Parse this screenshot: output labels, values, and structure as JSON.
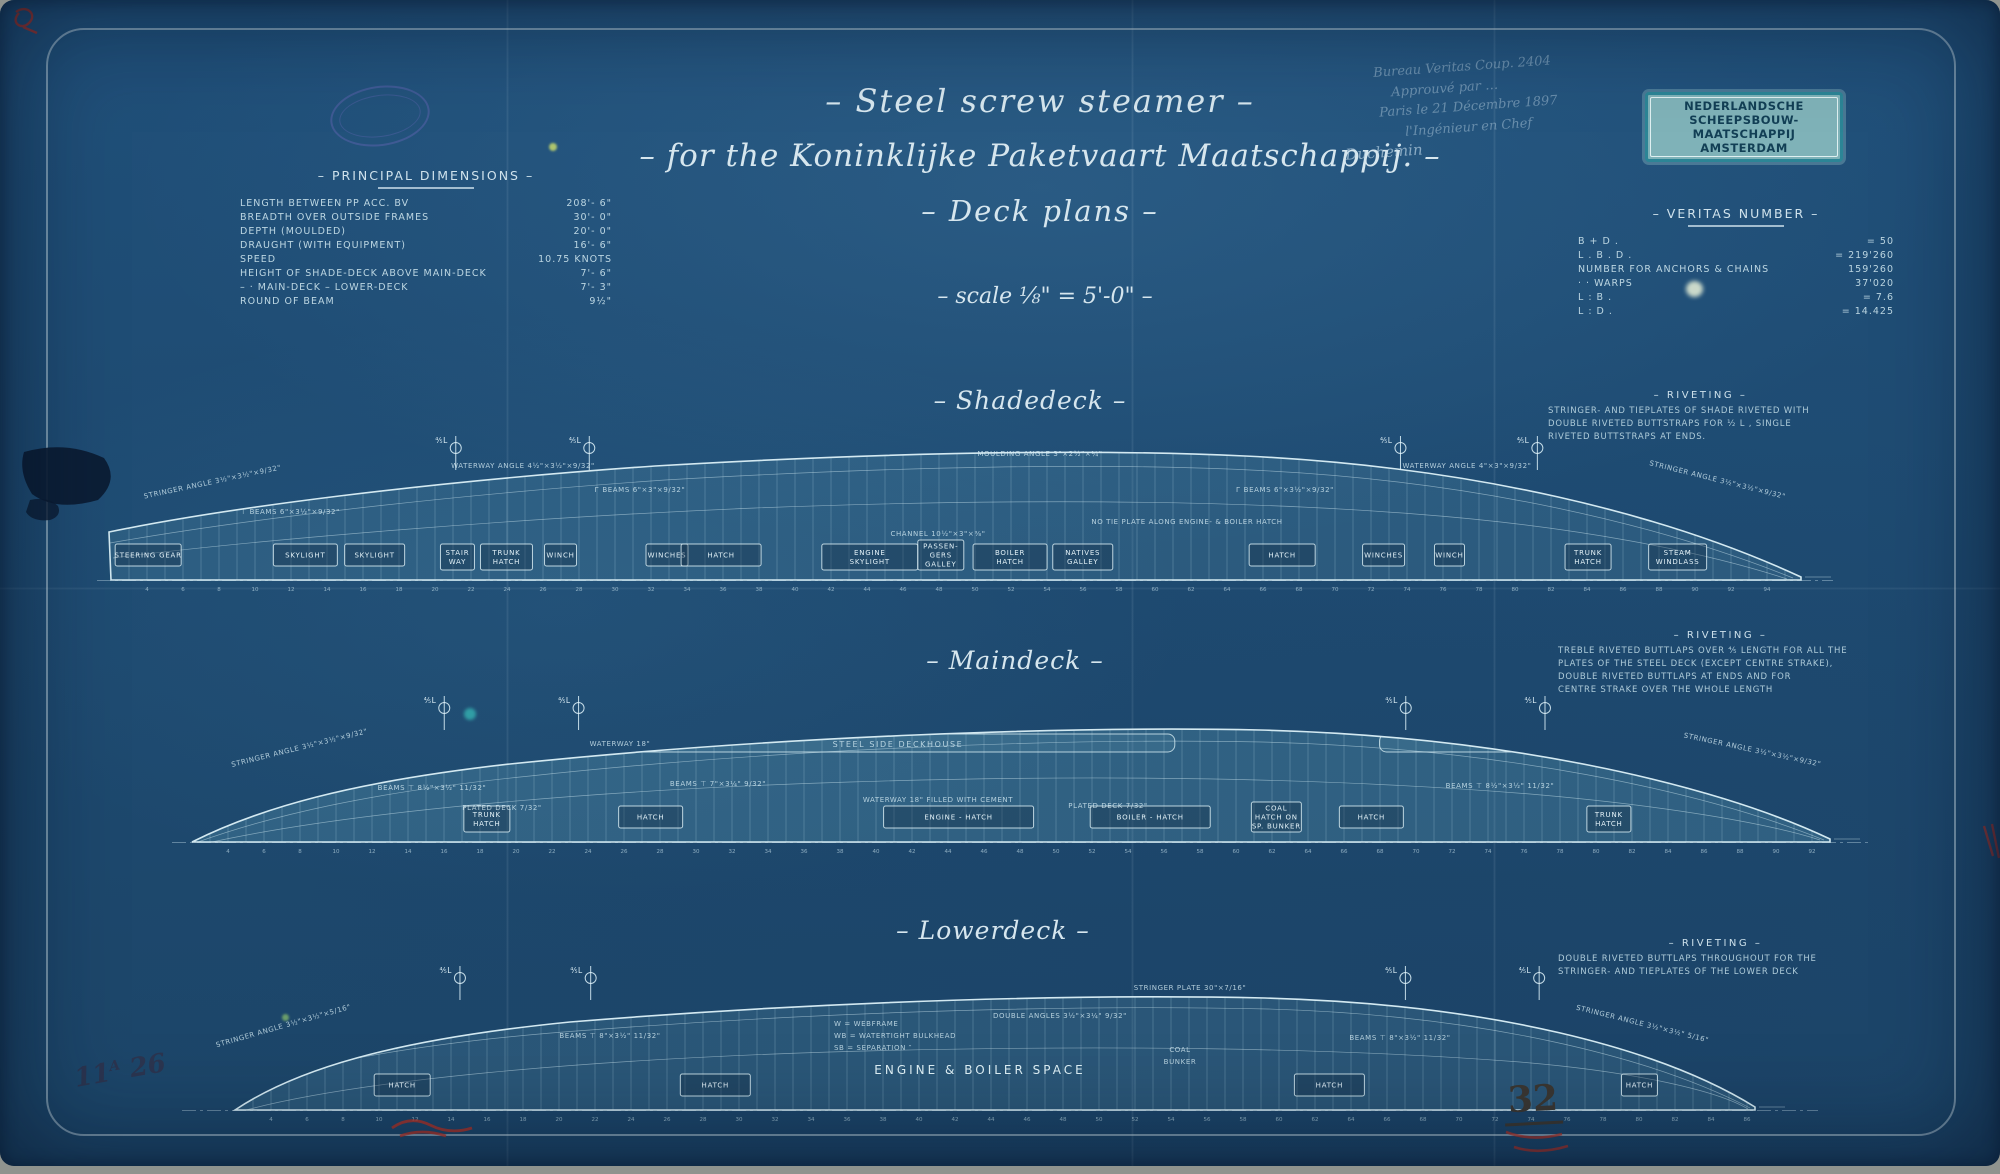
{
  "header": {
    "title_line1": "– Steel screw steamer –",
    "title_line2": "– for the Koninklijke Paketvaart Maatschappij. –",
    "title_line3": "– Deck plans –",
    "scale_line": "– scale ⅛\" = 5'-0\" –"
  },
  "principal_dimensions": {
    "heading": "– PRINCIPAL DIMENSIONS –",
    "rows": [
      {
        "label": "LENGTH BETWEEN PP ACC. BV",
        "value": "208'- 6\""
      },
      {
        "label": "BREADTH OVER OUTSIDE FRAMES",
        "value": "30'- 0\""
      },
      {
        "label": "DEPTH (MOULDED)",
        "value": "20'- 0\""
      },
      {
        "label": "DRAUGHT (WITH EQUIPMENT)",
        "value": "16'- 6\""
      },
      {
        "label": "SPEED",
        "value": "10.75 KNOTS"
      },
      {
        "label": "HEIGHT OF SHADE-DECK ABOVE MAIN-DECK",
        "value": "7'- 6\""
      },
      {
        "label": "–   ·   MAIN-DECK   –   LOWER-DECK",
        "value": "7'- 3\""
      },
      {
        "label": "ROUND OF BEAM",
        "value": "9½\""
      }
    ]
  },
  "builder_stamp": {
    "line1": "NEDERLANDSCHE",
    "line2": "SCHEEPSBOUW-MAATSCHAPPIJ",
    "line3": "AMSTERDAM"
  },
  "handwritten_approval": {
    "lines": [
      {
        "text": "Bureau Veritas Coup. 2404",
        "strong": false
      },
      {
        "text": "Approuvé par …",
        "strong": false
      },
      {
        "text": "Paris le 21 Décembre 1897",
        "strong": false
      },
      {
        "text": "l'Ingénieur en Chef",
        "strong": false
      },
      {
        "text": "Duchemin",
        "strong": true
      }
    ]
  },
  "veritas_number": {
    "heading": "– VERITAS NUMBER –",
    "rows": [
      {
        "label": "B + D .",
        "value": "= 50"
      },
      {
        "label": "L . B . D .",
        "value": "= 219'260"
      },
      {
        "label": "NUMBER FOR ANCHORS & CHAINS",
        "value": "159'260"
      },
      {
        "label": "·      ·      WARPS",
        "value": "37'020"
      },
      {
        "label": "L : B .",
        "value": "= 7.6"
      },
      {
        "label": "L : D .",
        "value": "= 14.425"
      }
    ]
  },
  "decks": [
    {
      "id": "shadedeck",
      "title": "– Shadedeck –",
      "mast_label": "⅘L",
      "frames_start": 2,
      "masts": [
        0.204,
        0.283,
        0.763,
        0.844
      ],
      "riveting": {
        "title": "– RIVETING –",
        "lines": [
          "STRINGER- AND TIEPLATES OF SHADE RIVETED WITH",
          "DOUBLE RIVETED BUTTSTRAPS FOR ½ L , SINGLE",
          "RIVETED BUTTSTRAPS AT ENDS."
        ]
      },
      "labels": [
        {
          "t": "STEERING GEAR",
          "f": 0.022,
          "w": 66
        },
        {
          "t": "SKYLIGHT",
          "f": 0.115,
          "w": 64
        },
        {
          "t": "SKYLIGHT",
          "f": 0.156,
          "w": 60
        },
        {
          "t": "STAIR\nWAY",
          "f": 0.205,
          "w": 34
        },
        {
          "t": "TRUNK\nHATCH",
          "f": 0.234,
          "w": 52
        },
        {
          "t": "WINCH",
          "f": 0.266,
          "w": 32
        },
        {
          "t": "WINCHES",
          "f": 0.329,
          "w": 42
        },
        {
          "t": "HATCH",
          "f": 0.361,
          "w": 80
        },
        {
          "t": "ENGINE\nSKYLIGHT",
          "f": 0.449,
          "w": 96
        },
        {
          "t": "PASSEN-\nGERS\nGALLEY",
          "f": 0.491,
          "w": 46
        },
        {
          "t": "BOILER\nHATCH",
          "f": 0.532,
          "w": 74
        },
        {
          "t": "NATIVES\nGALLEY",
          "f": 0.575,
          "w": 60
        },
        {
          "t": "HATCH",
          "f": 0.693,
          "w": 66
        },
        {
          "t": "WINCHES",
          "f": 0.753,
          "w": 42
        },
        {
          "t": "WINCH",
          "f": 0.792,
          "w": 30
        },
        {
          "t": "TRUNK\nHATCH",
          "f": 0.874,
          "w": 46
        },
        {
          "t": "STEAM\nWINDLASS",
          "f": 0.927,
          "w": 58
        }
      ],
      "notes": [
        {
          "t": "STRINGER ANGLE 3½\"×3½\"×9/32\"",
          "x": 118,
          "y": 54,
          "r": -12
        },
        {
          "t": "⊤ BEAMS 6\"×3½\"×9/32\"",
          "x": 195,
          "y": 84
        },
        {
          "t": "Г BEAMS 6\"×3\"×9/32\"",
          "x": 545,
          "y": 62
        },
        {
          "t": "WATERWAY ANGLE 4½\"×3½\"×9/32\"",
          "x": 428,
          "y": 38
        },
        {
          "t": "MOULDING ANGLE 3\"×2½\"×¼\"",
          "x": 945,
          "y": 26
        },
        {
          "t": "NO TIE PLATE ALONG ENGINE- & BOILER HATCH",
          "x": 1092,
          "y": 94
        },
        {
          "t": "CHANNEL 10½\"×3\"×⅜\"",
          "x": 843,
          "y": 106
        },
        {
          "t": "Г BEAMS 6\"×3½\"×9/32\"",
          "x": 1190,
          "y": 62
        },
        {
          "t": "WATERWAY ANGLE 4\"×3\"×9/32\"",
          "x": 1372,
          "y": 38
        },
        {
          "t": "STRINGER ANGLE 3½\"×3½\"×9/32\"",
          "x": 1622,
          "y": 52,
          "r": 14
        }
      ]
    },
    {
      "id": "maindeck",
      "title": "– Maindeck –",
      "mast_label": "⅘L",
      "frames_start": 2,
      "deckhouse_label": "STEEL SIDE DECKHOUSE",
      "masts": [
        0.154,
        0.236,
        0.741,
        0.826
      ],
      "riveting": {
        "title": "– RIVETING –",
        "lines": [
          "TREBLE RIVETED BUTTLAPS OVER ⅘ LENGTH FOR ALL THE",
          "PLATES OF THE STEEL DECK (EXCEPT CENTRE STRAKE),",
          "DOUBLE RIVETED BUTTLAPS AT ENDS AND FOR",
          "CENTRE STRAKE OVER THE WHOLE LENGTH"
        ]
      },
      "labels": [
        {
          "t": "TRUNK\nHATCH",
          "f": 0.18,
          "w": 46
        },
        {
          "t": "HATCH",
          "f": 0.28,
          "w": 64
        },
        {
          "t": "ENGINE - HATCH",
          "f": 0.468,
          "w": 150
        },
        {
          "t": "BOILER - HATCH",
          "f": 0.585,
          "w": 120
        },
        {
          "t": "COAL\nHATCH ON\nSP. BUNKER",
          "f": 0.662,
          "w": 50
        },
        {
          "t": "HATCH",
          "f": 0.72,
          "w": 64
        },
        {
          "t": "TRUNK\nHATCH",
          "f": 0.865,
          "w": 44
        }
      ],
      "notes": [
        {
          "t": "STRINGER ANGLE 3½\"×3½\"×9/32\"",
          "x": 130,
          "y": 60,
          "r": -14
        },
        {
          "t": "WATERWAY 18\"",
          "x": 450,
          "y": 56
        },
        {
          "t": "BEAMS ⊤ 8½\"×3½\" 11/32\"",
          "x": 262,
          "y": 100
        },
        {
          "t": "PLATED DECK 7/32\"",
          "x": 332,
          "y": 120
        },
        {
          "t": "BEAMS ⊤ 7\"×3¼\" 9/32\"",
          "x": 548,
          "y": 96
        },
        {
          "t": "WATERWAY 18\" FILLED WITH CEMENT",
          "x": 768,
          "y": 112
        },
        {
          "t": "PLATED DECK 7/32\"",
          "x": 938,
          "y": 118
        },
        {
          "t": "BEAMS ⊤ 8½\"×3½\" 11/32\"",
          "x": 1330,
          "y": 98
        },
        {
          "t": "STRINGER ANGLE 3½\"×3½\"×9/32\"",
          "x": 1582,
          "y": 62,
          "r": 12
        }
      ]
    },
    {
      "id": "lowerdeck",
      "title": "– Lowerdeck –",
      "mast_label": "⅘L",
      "frames_start": 2,
      "masts": [
        0.148,
        0.234,
        0.77,
        0.858
      ],
      "riveting": {
        "title": "– RIVETING –",
        "lines": [
          "DOUBLE RIVETED BUTTLAPS THROUGHOUT FOR THE",
          "STRINGER- AND TIEPLATES OF THE LOWER DECK"
        ]
      },
      "labels": [
        {
          "t": "HATCH",
          "f": 0.11,
          "w": 56
        },
        {
          "t": "HATCH",
          "f": 0.316,
          "w": 70
        },
        {
          "t": "HATCH",
          "f": 0.72,
          "w": 70
        },
        {
          "t": "HATCH",
          "f": 0.924,
          "w": 36
        }
      ],
      "notes": [
        {
          "t": "STRINGER ANGLE 3½\"×3½\"×5/16\"",
          "x": 104,
          "y": 68,
          "r": -16
        },
        {
          "t": "BEAMS ⊤ 8\"×3½\" 11/32\"",
          "x": 430,
          "y": 78
        },
        {
          "t": "W = WEBFRAME",
          "x": 654,
          "y": 66,
          "anchor": "start"
        },
        {
          "t": "WB = WATERTIGHT BULKHEAD",
          "x": 654,
          "y": 78,
          "anchor": "start"
        },
        {
          "t": "SB = SEPARATION  ″",
          "x": 654,
          "y": 90,
          "anchor": "start"
        },
        {
          "t": "DOUBLE ANGLES 3½\"×3¼\" 9/32\"",
          "x": 880,
          "y": 58
        },
        {
          "t": "ENGINE & BOILER SPACE",
          "x": 800,
          "y": 114,
          "big": true
        },
        {
          "t": "COAL",
          "x": 1000,
          "y": 92
        },
        {
          "t": "BUNKER",
          "x": 1000,
          "y": 104
        },
        {
          "t": "STRINGER PLATE 30\"×7/16\"",
          "x": 1010,
          "y": 30
        },
        {
          "t": "BEAMS ⊤ 8\"×3½\" 11/32\"",
          "x": 1220,
          "y": 80
        },
        {
          "t": "STRINGER ANGLE 3½\"×3½\" 5/16\"",
          "x": 1462,
          "y": 66,
          "r": 14
        }
      ]
    }
  ],
  "margin_marks": {
    "inventory_prefix": "11",
    "inventory_sup": "A",
    "inventory_suffix": "26",
    "sheet_number": "32"
  },
  "colors": {
    "paper_blue": "#1e4a6f",
    "line_ink": "#d3e9f1",
    "stamp_teal": "#2c8596",
    "red_pencil": "#b23226"
  }
}
